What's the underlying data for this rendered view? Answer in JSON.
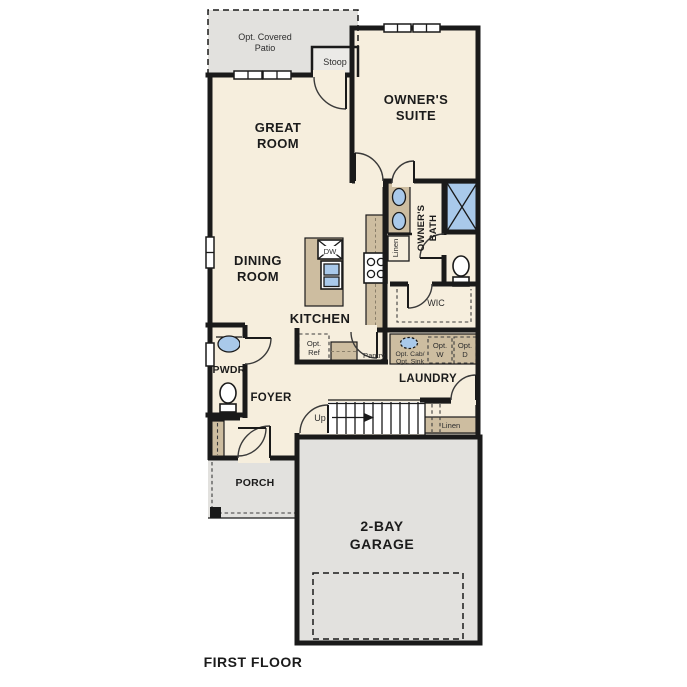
{
  "plan": {
    "title": "FIRST FLOOR",
    "rooms": {
      "patio_line1": "Opt. Covered",
      "patio_line2": "Patio",
      "stoop": "Stoop",
      "great_room_line1": "GREAT",
      "great_room_line2": "ROOM",
      "owners_suite_line1": "OWNER'S",
      "owners_suite_line2": "SUITE",
      "owners_bath_line1": "OWNER'S",
      "owners_bath_line2": "BATH",
      "dining_room_line1": "DINING",
      "dining_room_line2": "ROOM",
      "kitchen": "KITCHEN",
      "wic": "WIC",
      "pwdr": "PWDR",
      "foyer": "FOYER",
      "pantry": "Pantry",
      "laundry": "LAUNDRY",
      "porch": "PORCH",
      "garage_line1": "2-BAY",
      "garage_line2": "GARAGE"
    },
    "features": {
      "bath_linen": "Linen",
      "hall_linen": "Linen",
      "dishwasher": "DW",
      "up": "Up",
      "opt_ref_line1": "Opt.",
      "opt_ref_line2": "Ref",
      "opt_cab": "Opt. Cab/",
      "opt_sink": "Opt. Sink",
      "opt_w_line1": "Opt.",
      "opt_w_line2": "W",
      "opt_d_line1": "Opt.",
      "opt_d_line2": "D"
    },
    "colors": {
      "wall": "#1a1a1a",
      "floor": "#f6eedd",
      "outdoor": "#e2e1de",
      "stoop_fill": "#ebeae7",
      "cabinet": "#cdbda0",
      "fixture_blue": "#a9c9ea",
      "optional_fill": "#dfe0df",
      "optional_wd_fill": "#d9dee3"
    }
  }
}
